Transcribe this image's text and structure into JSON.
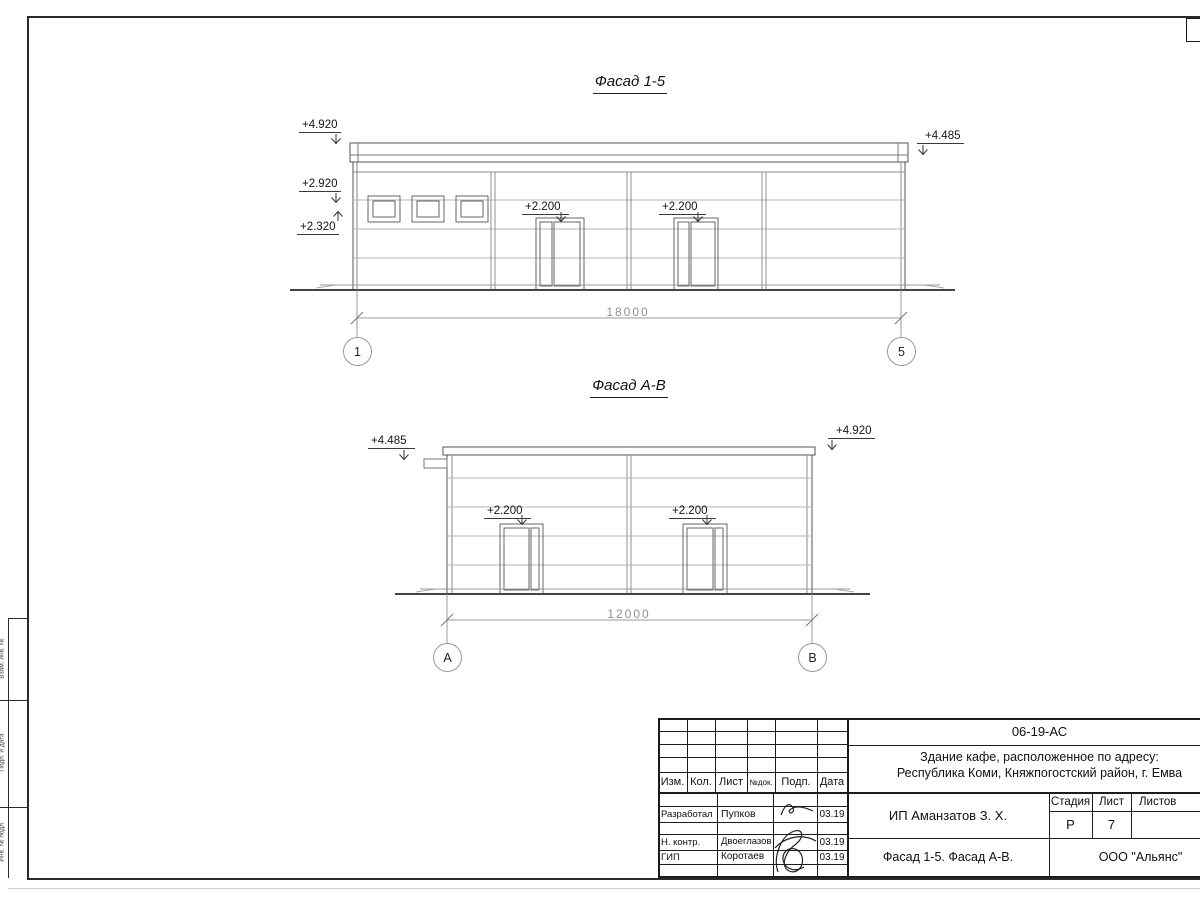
{
  "colors": {
    "frame_line": "#1c1c1c",
    "outline": "#555555",
    "panel_line": "#b5b5b5",
    "dim_line": "#9a9a9a"
  },
  "frame": {
    "strip": [
      "Взам. инв. №",
      "Подп. и дата",
      "Инв. № подл."
    ]
  },
  "facade1": {
    "title": "Фасад 1-5",
    "elev_top_left": "+4.920",
    "elev_mid_left": "+2.920",
    "elev_low_left": "+2.320",
    "elev_top_right": "+4.485",
    "elev_door1": "+2.200",
    "elev_door2": "+2.200",
    "dimension": "18000",
    "axis_left": "1",
    "axis_right": "5"
  },
  "facade2": {
    "title": "Фасад А-В",
    "elev_top_left": "+4.485",
    "elev_top_right": "+4.920",
    "elev_door1": "+2.200",
    "elev_door2": "+2.200",
    "dimension": "12000",
    "axis_left": "А",
    "axis_right": "В"
  },
  "titleblock": {
    "doc_number": "06-19-АС",
    "project_line1": "Здание кафе, расположенное по адресу:",
    "project_line2": "Республика Коми, Княжпогостский район, г. Емва",
    "cols": {
      "izm": "Изм.",
      "kol": "Кол.",
      "list": "Лист",
      "ndok": "№док.",
      "podp": "Подп.",
      "data": "Дата"
    },
    "rows": [
      {
        "role": "Разработал",
        "name": "Пупков",
        "date": "03.19"
      },
      {
        "role": "Н. контр.",
        "name": "Двоеглазов",
        "date": "03.19"
      },
      {
        "role": "ГИП",
        "name": "Коротаев",
        "date": "03.19"
      }
    ],
    "client": "ИП Аманзатов З. Х.",
    "stage_label": "Стадия",
    "sheet_label": "Лист",
    "sheets_label": "Листов",
    "stage_value": "Р",
    "sheet_value": "7",
    "sheet_title": "Фасад 1-5. Фасад А-В.",
    "company": "ООО \"Альянс\""
  }
}
